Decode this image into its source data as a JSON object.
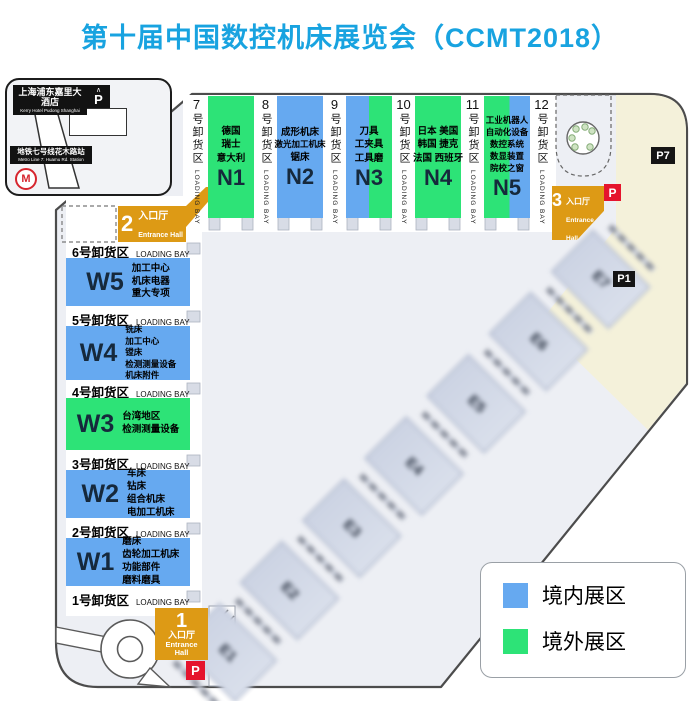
{
  "title": "第十届中国数控机床展览会（CCMT2018）",
  "hotel_inset": {
    "hotel_cn": "上海浦东嘉里大酒店",
    "hotel_en": "Kerry Hotel Pudong Shanghai",
    "metro_cn": "地铁七号线花木路站",
    "metro_en": "Metro Line 7: Huamu Rd. Station",
    "metro_logo": "M",
    "parking_letter": "P"
  },
  "entrances": {
    "e1": {
      "num": "1",
      "cn": "入口厅",
      "en": "Entrance Hall"
    },
    "e2": {
      "num": "2",
      "cn": "入口厅",
      "en": "Entrance Hall"
    },
    "e3": {
      "num": "3",
      "cn": "入口厅",
      "en": "Entrance Hall"
    }
  },
  "parking": {
    "p7": "P7",
    "p1": "P1",
    "p": "P"
  },
  "loading_bays_north": [
    {
      "num": "7",
      "cn": "号卸货区",
      "en": "LOADING BAY"
    },
    {
      "num": "8",
      "cn": "号卸货区",
      "en": "LOADING BAY"
    },
    {
      "num": "9",
      "cn": "号卸货区",
      "en": "LOADING BAY"
    },
    {
      "num": "10",
      "cn": "号卸货区",
      "en": "LOADING BAY"
    },
    {
      "num": "11",
      "cn": "号卸货区",
      "en": "LOADING BAY"
    },
    {
      "num": "12",
      "cn": "号卸货区",
      "en": "LOADING BAY"
    }
  ],
  "loading_bays_west": [
    {
      "cn": "6号卸货区",
      "en": "LOADING BAY"
    },
    {
      "cn": "5号卸货区",
      "en": "LOADING BAY"
    },
    {
      "cn": "4号卸货区",
      "en": "LOADING BAY"
    },
    {
      "cn": "3号卸货区",
      "en": "LOADING BAY"
    },
    {
      "cn": "2号卸货区",
      "en": "LOADING BAY"
    },
    {
      "cn": "1号卸货区",
      "en": "LOADING BAY"
    }
  ],
  "halls": {
    "N1": {
      "label": "N1",
      "lines": [
        "德国",
        "瑞士",
        "意大利"
      ]
    },
    "N2": {
      "label": "N2",
      "lines": [
        "成形机床",
        "激光加工机床",
        "锯床"
      ]
    },
    "N3": {
      "label": "N3",
      "lines": [
        "刀具",
        "工夹具",
        "工具磨"
      ]
    },
    "N4": {
      "label": "N4",
      "lines": [
        "日本 美国",
        "韩国 捷克",
        "法国 西班牙"
      ]
    },
    "N5": {
      "label": "N5",
      "lines": [
        "工业机器人",
        "自动化设备",
        "数控系统",
        "数显装置",
        "院校之窗"
      ]
    },
    "W5": {
      "label": "W5",
      "lines": [
        "加工中心",
        "机床电器",
        "重大专项"
      ]
    },
    "W4": {
      "label": "W4",
      "lines": [
        "铣床",
        "加工中心",
        "镗床",
        "检测测量设备",
        "机床附件"
      ]
    },
    "W3": {
      "label": "W3",
      "lines": [
        "台湾地区",
        "检测测量设备"
      ]
    },
    "W2": {
      "label": "W2",
      "lines": [
        "车床",
        "钻床",
        "组合机床",
        "电加工机床"
      ]
    },
    "W1": {
      "label": "W1",
      "lines": [
        "磨床",
        "齿轮加工机床",
        "功能部件",
        "磨料磨具"
      ]
    }
  },
  "east_halls": [
    "E1",
    "E2",
    "E3",
    "E4",
    "E5",
    "E6",
    "E7"
  ],
  "legend": {
    "domestic_label": "境内展区",
    "overseas_label": "境外展区"
  },
  "colors": {
    "domestic": "#66a9f0",
    "overseas": "#2de377",
    "entrance_gold": "#dd9a15",
    "title_blue": "#18a3e0",
    "parking_red": "#e5142d",
    "parking_beige": "#f4f1da"
  }
}
